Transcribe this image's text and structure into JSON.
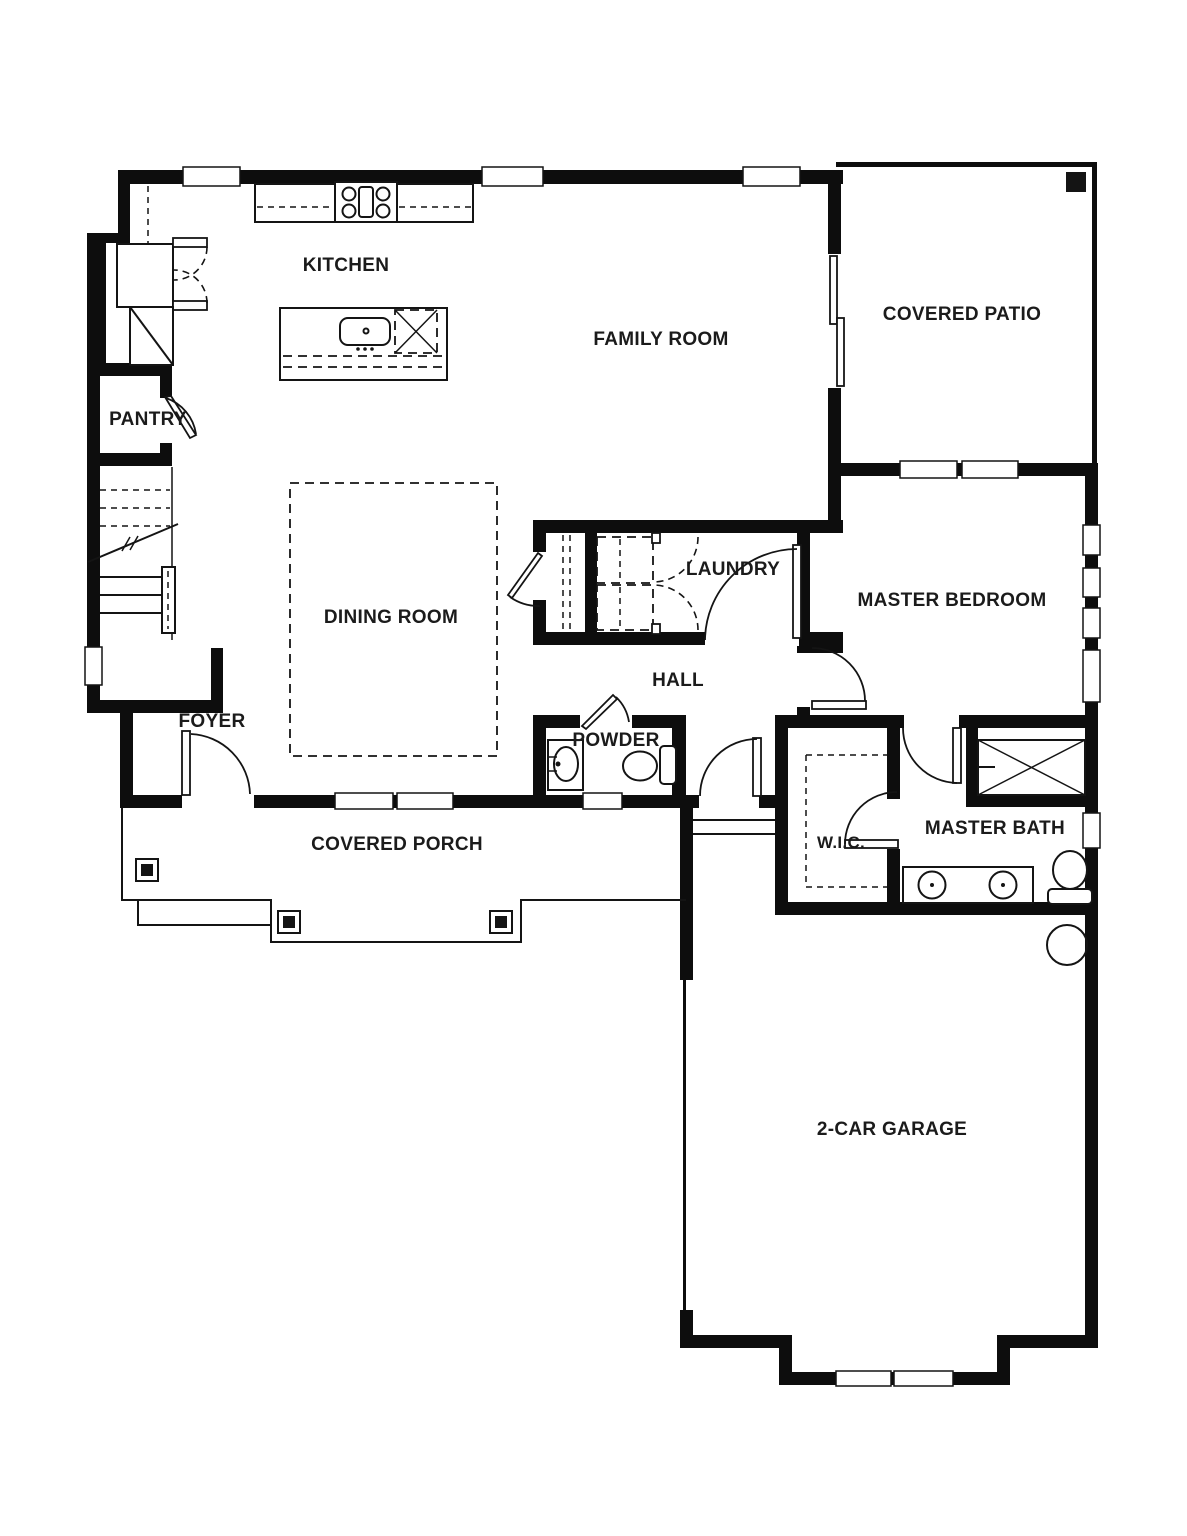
{
  "title": "Floor Plan",
  "colors": {
    "background": "#ffffff",
    "walls": "#0d0d0d",
    "lines": "#141414",
    "text": "#1b1b1b"
  },
  "rooms": [
    {
      "id": "kitchen",
      "label": "KITCHEN"
    },
    {
      "id": "family-room",
      "label": "FAMILY ROOM"
    },
    {
      "id": "covered-patio",
      "label": "COVERED PATIO"
    },
    {
      "id": "pantry",
      "label": "PANTRY"
    },
    {
      "id": "dining-room",
      "label": "DINING ROOM"
    },
    {
      "id": "laundry",
      "label": "LAUNDRY"
    },
    {
      "id": "hall",
      "label": "HALL"
    },
    {
      "id": "master-bedroom",
      "label": "MASTER BEDROOM"
    },
    {
      "id": "powder",
      "label": "POWDER"
    },
    {
      "id": "foyer",
      "label": "FOYER"
    },
    {
      "id": "covered-porch",
      "label": "COVERED PORCH"
    },
    {
      "id": "wic",
      "label": "W.I.C."
    },
    {
      "id": "master-bath",
      "label": "MASTER BATH"
    },
    {
      "id": "garage",
      "label": "2-CAR GARAGE"
    }
  ],
  "fixtures": [
    "range-cooktop",
    "kitchen-counter",
    "refrigerator",
    "corner-cabinet",
    "kitchen-island",
    "island-sink",
    "dishwasher",
    "washer",
    "dryer",
    "stairs",
    "stair-handrail",
    "front-door",
    "sliding-glass-door",
    "pantry-door",
    "powder-sink",
    "powder-toilet",
    "shower",
    "double-vanity",
    "master-toilet",
    "walk-in-closet-shelves",
    "water-heater",
    "porch-posts",
    "patio-post",
    "garage-door",
    "windows"
  ]
}
